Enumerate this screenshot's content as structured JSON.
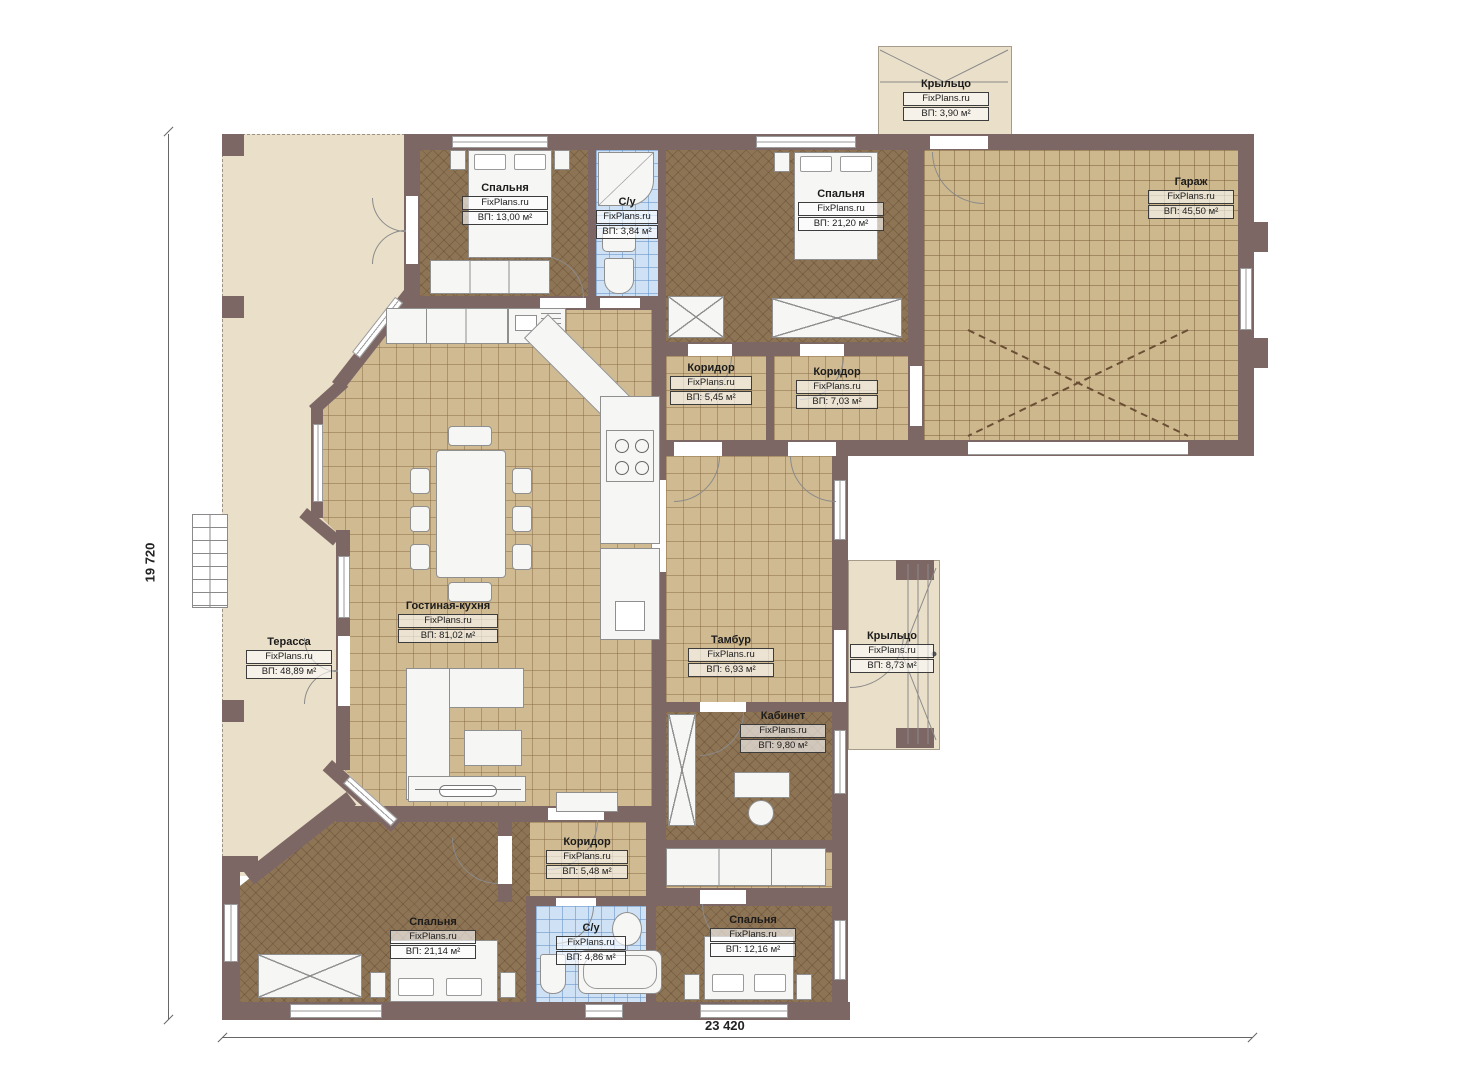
{
  "plan": {
    "watermark": "FixPlans.ru",
    "dimensions": {
      "height_label": "19 720",
      "width_label": "23 420"
    },
    "rooms": [
      {
        "id": "porch-top",
        "name": "Крыльцо",
        "area": "ВП: 3,90 м²"
      },
      {
        "id": "bedroom-1",
        "name": "Спальня",
        "area": "ВП: 13,00 м²"
      },
      {
        "id": "bathroom-1",
        "name": "С/у",
        "area": "ВП: 3,84 м²"
      },
      {
        "id": "bedroom-2",
        "name": "Спальня",
        "area": "ВП: 21,20 м²"
      },
      {
        "id": "garage",
        "name": "Гараж",
        "area": "ВП: 45,50 м²"
      },
      {
        "id": "corridor-1",
        "name": "Коридор",
        "area": "ВП: 5,45 м²"
      },
      {
        "id": "corridor-2",
        "name": "Коридор",
        "area": "ВП: 7,03 м²"
      },
      {
        "id": "living-kitchen",
        "name": "Гостиная-кухня",
        "area": "ВП: 81,02 м²"
      },
      {
        "id": "terrace",
        "name": "Терасса",
        "area": "ВП: 48,89 м²"
      },
      {
        "id": "vestibule",
        "name": "Тамбур",
        "area": "ВП: 6,93 м²"
      },
      {
        "id": "porch-right",
        "name": "Крыльцо",
        "area": "ВП: 8,73 м²"
      },
      {
        "id": "office",
        "name": "Кабинет",
        "area": "ВП: 9,80 м²"
      },
      {
        "id": "corridor-3",
        "name": "Коридор",
        "area": "ВП: 5,48 м²"
      },
      {
        "id": "bedroom-3",
        "name": "Спальня",
        "area": "ВП: 21,14 м²"
      },
      {
        "id": "bathroom-2",
        "name": "С/у",
        "area": "ВП: 4,86 м²"
      },
      {
        "id": "bedroom-4",
        "name": "Спальня",
        "area": "ВП: 12,16 м²"
      }
    ],
    "colors": {
      "wall": "#7d6765",
      "tile_floor": "#cfba92",
      "dark_floor": "#8d7455",
      "terrace": "#eadfc8",
      "bath_tile": "#cfe2f5"
    }
  }
}
